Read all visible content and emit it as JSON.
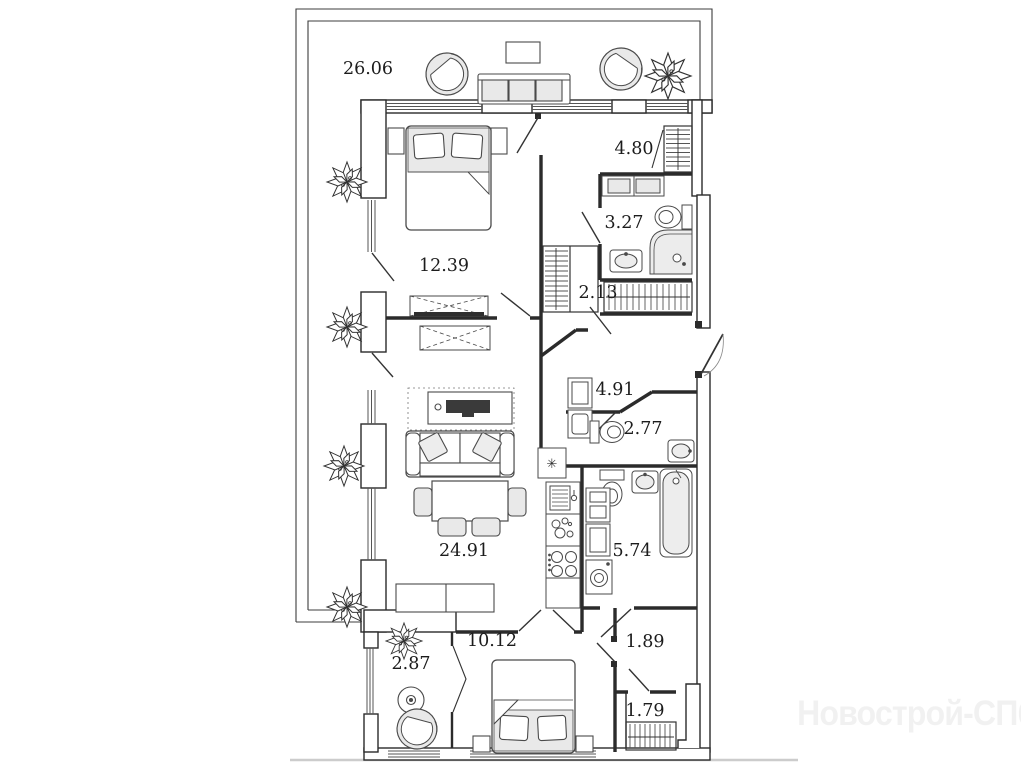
{
  "plan": {
    "watermark": "Новострой-СПб",
    "vent_symbol": "✳",
    "rooms": [
      {
        "id": "terrace",
        "area": "26.06"
      },
      {
        "id": "bedroom-1",
        "area": "12.39"
      },
      {
        "id": "entry-hall",
        "area": "4.80"
      },
      {
        "id": "bathroom-1",
        "area": "3.27"
      },
      {
        "id": "wardrobe-niche",
        "area": "2.13"
      },
      {
        "id": "hallway",
        "area": "4.91"
      },
      {
        "id": "wc",
        "area": "2.77"
      },
      {
        "id": "living-kitchen",
        "area": "24.91"
      },
      {
        "id": "bathroom-2",
        "area": "5.74"
      },
      {
        "id": "bedroom-2",
        "area": "10.12"
      },
      {
        "id": "balcony",
        "area": "2.87"
      },
      {
        "id": "hall-2",
        "area": "1.89"
      },
      {
        "id": "closet",
        "area": "1.79"
      }
    ],
    "colors": {
      "wall": "#2b2b2b",
      "furniture_line": "#4a4a4a",
      "furniture_fill": "#e9e9e9",
      "ground_line": "#cccccc",
      "watermark_text": "#f1f1f1"
    }
  }
}
